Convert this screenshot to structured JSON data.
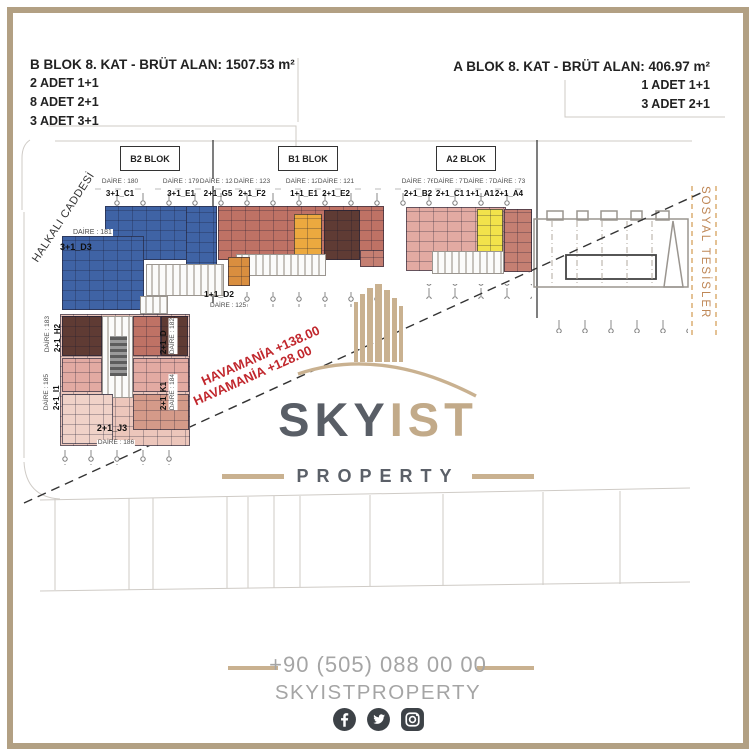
{
  "header": {
    "left_title": "B BLOK 8. KAT - BRÜT ALAN: 1507.53 m²",
    "left_lines": [
      "2 ADET 1+1",
      "8 ADET 2+1",
      "3 ADET 3+1"
    ],
    "right_title": "A BLOK 8. KAT - BRÜT ALAN: 406.97 m²",
    "right_lines": [
      "1 ADET 1+1",
      "3 ADET 2+1"
    ]
  },
  "blocks": {
    "b2": "B2 BLOK",
    "b1": "B1 BLOK",
    "a2": "A2 BLOK"
  },
  "streets": {
    "left": "HALKALI CADDESİ",
    "right": "SOSYAL TESİSLER"
  },
  "top_units": [
    {
      "daire": "DAİRE : 180",
      "unit": "3+1_C1"
    },
    {
      "daire": "DAİRE : 179",
      "unit": "3+1_E1"
    },
    {
      "daire": "DAİRE : 124",
      "unit": "2+1_G5"
    },
    {
      "daire": "DAİRE : 123",
      "unit": "2+1_F2"
    },
    {
      "daire": "DAİRE : 122",
      "unit": "1+1_E1"
    },
    {
      "daire": "DAİRE : 121",
      "unit": "2+1_E2"
    },
    {
      "daire": "DAİRE : 76",
      "unit": "2+1_B2"
    },
    {
      "daire": "DAİRE : 75",
      "unit": "2+1_C1"
    },
    {
      "daire": "DAİRE : 74",
      "unit": "1+1_A1"
    },
    {
      "daire": "DAİRE : 73",
      "unit": "2+1_A4"
    }
  ],
  "side_units": {
    "d181": {
      "daire": "DAİRE : 181",
      "unit": "3+1_D3"
    },
    "d125": {
      "daire": "DAİRE : 125",
      "unit": "1+1_D2"
    },
    "d183": {
      "daire": "DAİRE : 183",
      "unit": "2+1_H2"
    },
    "d185": {
      "daire": "DAİRE : 185",
      "unit": "2+1_I1"
    },
    "d182": {
      "daire": "DAİRE : 182",
      "unit": "2+1_D"
    },
    "d184": {
      "daire": "DAİRE : 184",
      "unit": "2+1_K1"
    },
    "d186": {
      "daire": "DAİRE : 186",
      "unit": "2+1_J3"
    }
  },
  "annotations": {
    "havamania_1": "HAVAMANİA +138.00",
    "havamania_2": "HAVAMANİA +128.00"
  },
  "logo": {
    "sky": "SKY",
    "ist": "IST",
    "tagline": "PROPERTY"
  },
  "footer": {
    "phone": "+90 (505) 088 00 00",
    "brand": "SKYISTPROPERTY",
    "icons": [
      "facebook-icon",
      "twitter-icon",
      "instagram-icon"
    ]
  },
  "colors": {
    "frame_tan": "#b2a083",
    "logo_tan": "#c9b190",
    "logo_gray": "#595e66",
    "footer_gray": "#a5a5a5",
    "annotation_red": "#c1272d",
    "street_orange": "#bf8756",
    "unit_blue": "#3f63a5",
    "unit_salmon": "#bf7265",
    "unit_brown": "#5f3b34",
    "unit_orange": "#d98e3f",
    "unit_amber": "#eca93f",
    "unit_yellow": "#f2e24b",
    "unit_pink": "#e2aaa2",
    "unit_rose": "#c57f72"
  }
}
